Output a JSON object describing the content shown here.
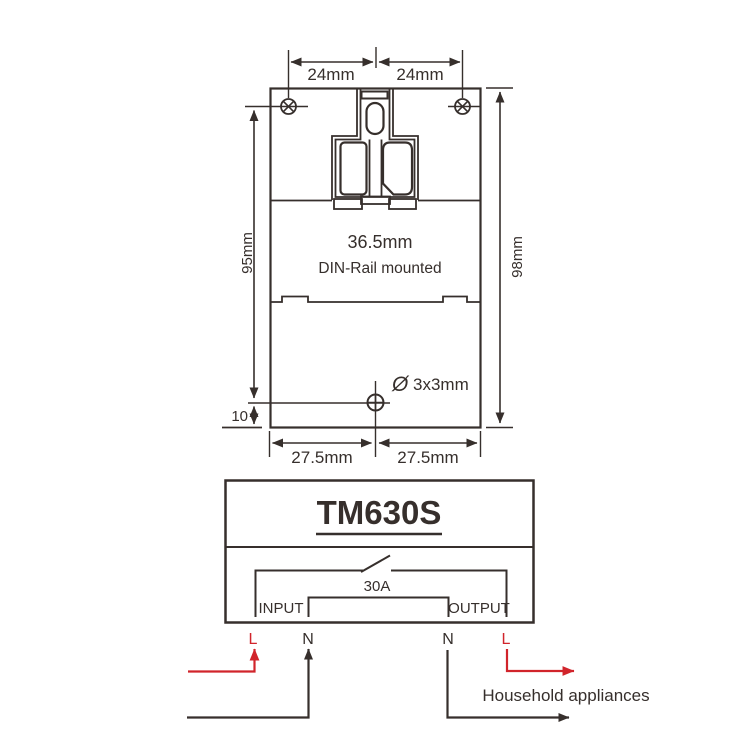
{
  "colors": {
    "line": "#362f2c",
    "accent_red": "#d1242b",
    "background": "#ffffff"
  },
  "dimension_drawing": {
    "top_left_dim": "24mm",
    "top_right_dim": "24mm",
    "left_dim": "95mm",
    "right_dim": "98mm",
    "width_dim": "36.5mm",
    "mount_note": "DIN-Rail mounted",
    "hole_symbol": "Ø",
    "hole_dim": "3x3mm",
    "offset_dim": "10",
    "bottom_left_dim": "27.5mm",
    "bottom_right_dim": "27.5mm"
  },
  "wiring_diagram": {
    "model": "TM630S",
    "switch_rating": "30A",
    "input_label": "INPUT",
    "output_label": "OUTPUT",
    "terminals": [
      {
        "label": "L",
        "color": "#d1242b"
      },
      {
        "label": "N",
        "color": "#362f2c"
      },
      {
        "label": "N",
        "color": "#362f2c"
      },
      {
        "label": "L",
        "color": "#d1242b"
      }
    ],
    "load_label": "Household appliances"
  }
}
